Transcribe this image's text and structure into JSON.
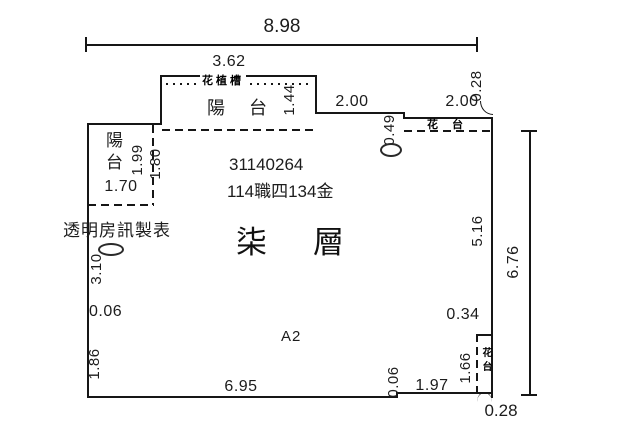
{
  "plan": {
    "ids": {
      "unit_number": "31140264",
      "registration_number": "114職四134金"
    },
    "labels": {
      "floor": "柒層",
      "zone": "A2",
      "watermark": "透明房訊製表",
      "balcony_top": "陽台",
      "balcony_left": "陽台",
      "planter_top": "花植槽",
      "flower_stand_top_right": "花台",
      "flower_stand_bottom_right": "花台"
    },
    "dimensions": {
      "total_width": "8.98",
      "total_height": "6.76",
      "top_balcony_width": "3.62",
      "top_balcony_depth": "1.44",
      "top_wall_left": "2.00",
      "top_wall_right": "2.00",
      "top_step": "0.49",
      "top_flower_stand_depth": "0.28",
      "left_balcony_width": "1.70",
      "left_balcony_depth_outer": "1.99",
      "left_balcony_depth_inner": "1.80",
      "left_wall_upper": "3.10",
      "left_wall_step": "0.06",
      "left_wall_lower": "1.86",
      "right_wall_inner": "5.16",
      "bottom_wall_main": "6.95",
      "bottom_wall_step": "0.06",
      "bottom_wall_right": "1.97",
      "bottom_flower_stand_height": "1.66",
      "bottom_flower_stand_width": "0.34",
      "bottom_flower_stand_depth": "0.28"
    }
  }
}
